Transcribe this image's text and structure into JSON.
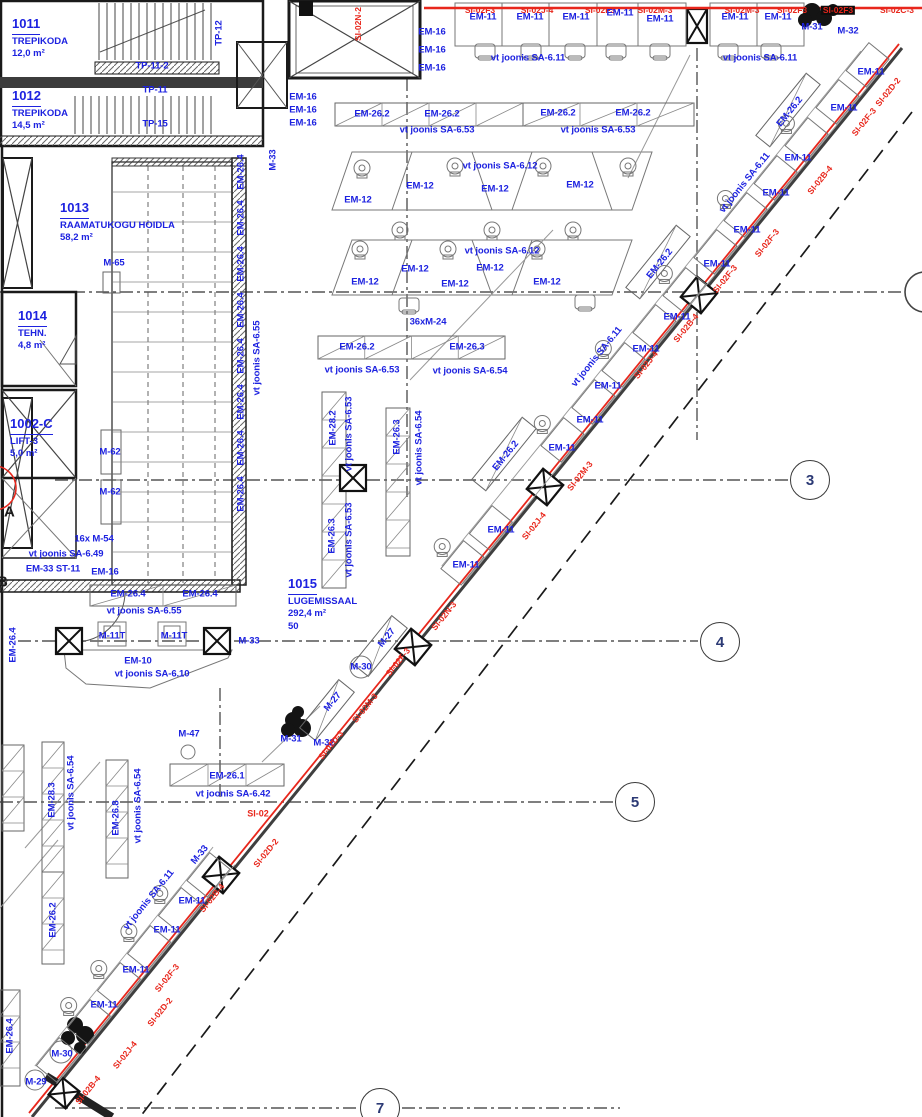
{
  "colors": {
    "blue": "#1d22e0",
    "red": "#e8271c",
    "black": "#1c1c1c",
    "wall": "#1a1a1a",
    "furniture": "#8a8a8a",
    "grid": "#555555"
  },
  "plan": {
    "rooms": [
      {
        "number": "1011",
        "name": "TREPIKODA",
        "area": "12,0 m²",
        "x": 12,
        "y": 14
      },
      {
        "number": "1012",
        "name": "TREPIKODA",
        "area": "14,5 m²",
        "x": 12,
        "y": 86
      },
      {
        "number": "1013",
        "name": "RAAMATUKOGU HOIDLA",
        "area": "58,2 m²",
        "x": 60,
        "y": 198
      },
      {
        "number": "1014",
        "name": "TEHN.",
        "area": "4,8 m²",
        "x": 18,
        "y": 306
      },
      {
        "number": "1002-C",
        "name": "LIFT-3",
        "area": "5,0 m²",
        "x": 10,
        "y": 414
      },
      {
        "number": "1015",
        "name": "LUGEMISSAAL",
        "area": "292,4 m²",
        "extra": "50",
        "x": 288,
        "y": 574
      }
    ],
    "grid_bubbles": [
      {
        "label": "3",
        "x": 810,
        "y": 480
      },
      {
        "label": "4",
        "x": 720,
        "y": 642
      },
      {
        "label": "5",
        "x": 635,
        "y": 802
      },
      {
        "label": "7",
        "x": 380,
        "y": 1108
      }
    ],
    "grid_letters": [
      {
        "label": "A",
        "x": 4,
        "y": 512
      },
      {
        "label": "B",
        "x": -3,
        "y": 582
      }
    ],
    "labels": [
      {
        "t": "TP-11-2",
        "x": 152,
        "y": 66
      },
      {
        "t": "TP-11",
        "x": 155,
        "y": 90
      },
      {
        "t": "TP-15",
        "x": 155,
        "y": 124
      },
      {
        "t": "TP-12",
        "x": 219,
        "y": 33,
        "rot": -90
      },
      {
        "t": "M-33",
        "x": 273,
        "y": 160,
        "rot": -90
      },
      {
        "t": "EM-16",
        "x": 303,
        "y": 97
      },
      {
        "t": "EM-16",
        "x": 303,
        "y": 110
      },
      {
        "t": "EM-16",
        "x": 303,
        "y": 123
      },
      {
        "t": "EM-16",
        "x": 432,
        "y": 32
      },
      {
        "t": "EM-16",
        "x": 432,
        "y": 50
      },
      {
        "t": "EM-16",
        "x": 432,
        "y": 68
      },
      {
        "t": "SI-02N-2",
        "x": 358,
        "y": 24,
        "rot": -90,
        "c": "red"
      },
      {
        "t": "SI-02F3",
        "x": 480,
        "y": 10,
        "c": "red"
      },
      {
        "t": "SI-02J-4",
        "x": 537,
        "y": 10,
        "c": "red"
      },
      {
        "t": "SI-02F3",
        "x": 600,
        "y": 10,
        "c": "red"
      },
      {
        "t": "SI-02M-3",
        "x": 655,
        "y": 10,
        "c": "red"
      },
      {
        "t": "SI-02M-3",
        "x": 742,
        "y": 10,
        "c": "red"
      },
      {
        "t": "SI-02F3",
        "x": 792,
        "y": 10,
        "c": "red"
      },
      {
        "t": "SI-02F3",
        "x": 838,
        "y": 10,
        "c": "red",
        "inv": true
      },
      {
        "t": "SI-02C-3",
        "x": 897,
        "y": 10,
        "c": "red"
      },
      {
        "t": "EM-11",
        "x": 483,
        "y": 17
      },
      {
        "t": "EM-11",
        "x": 530,
        "y": 17
      },
      {
        "t": "EM-11",
        "x": 576,
        "y": 17
      },
      {
        "t": "EM-11",
        "x": 620,
        "y": 13
      },
      {
        "t": "EM-11",
        "x": 660,
        "y": 19
      },
      {
        "t": "EM-11",
        "x": 735,
        "y": 17
      },
      {
        "t": "EM-11",
        "x": 778,
        "y": 17
      },
      {
        "t": "vt joonis SA-6.11",
        "x": 528,
        "y": 58
      },
      {
        "t": "vt joonis SA-6.11",
        "x": 760,
        "y": 58
      },
      {
        "t": "M-31",
        "x": 812,
        "y": 27
      },
      {
        "t": "M-32",
        "x": 848,
        "y": 31
      },
      {
        "t": "EM-26.2",
        "x": 372,
        "y": 114
      },
      {
        "t": "EM-26.2",
        "x": 442,
        "y": 114
      },
      {
        "t": "EM-26.2",
        "x": 558,
        "y": 113
      },
      {
        "t": "EM-26.2",
        "x": 633,
        "y": 113
      },
      {
        "t": "vt joonis SA-6.53",
        "x": 437,
        "y": 130
      },
      {
        "t": "vt joonis SA-6.53",
        "x": 598,
        "y": 130
      },
      {
        "t": "vt joonis SA-6.12",
        "x": 500,
        "y": 166
      },
      {
        "t": "EM-12",
        "x": 358,
        "y": 200
      },
      {
        "t": "EM-12",
        "x": 420,
        "y": 186
      },
      {
        "t": "EM-12",
        "x": 495,
        "y": 189
      },
      {
        "t": "EM-12",
        "x": 580,
        "y": 185
      },
      {
        "t": "vt joonis SA-6.12",
        "x": 502,
        "y": 251
      },
      {
        "t": "EM-12",
        "x": 365,
        "y": 282
      },
      {
        "t": "EM-12",
        "x": 415,
        "y": 269
      },
      {
        "t": "EM-12",
        "x": 455,
        "y": 284
      },
      {
        "t": "EM-12",
        "x": 490,
        "y": 268
      },
      {
        "t": "EM-12",
        "x": 547,
        "y": 282
      },
      {
        "t": "36xM-24",
        "x": 428,
        "y": 322
      },
      {
        "t": "EM-26.2",
        "x": 357,
        "y": 347
      },
      {
        "t": "EM-26.3",
        "x": 467,
        "y": 347
      },
      {
        "t": "vt joonis SA-6.53",
        "x": 362,
        "y": 370
      },
      {
        "t": "vt joonis SA-6.54",
        "x": 470,
        "y": 371
      },
      {
        "t": "EM-28.2",
        "x": 333,
        "y": 428,
        "rot": -90
      },
      {
        "t": "vt joonis SA-6.53",
        "x": 349,
        "y": 434,
        "rot": -90
      },
      {
        "t": "EM-26.3",
        "x": 332,
        "y": 536,
        "rot": -90
      },
      {
        "t": "vt joonis SA-6.53",
        "x": 349,
        "y": 540,
        "rot": -90
      },
      {
        "t": "EM-26.3",
        "x": 397,
        "y": 437,
        "rot": -90
      },
      {
        "t": "vt joonis SA-6.54",
        "x": 419,
        "y": 448,
        "rot": -90
      },
      {
        "t": "EM-26.4",
        "x": 241,
        "y": 172,
        "rot": -90
      },
      {
        "t": "EM-26.4",
        "x": 241,
        "y": 218,
        "rot": -90
      },
      {
        "t": "EM-26.4",
        "x": 241,
        "y": 264,
        "rot": -90
      },
      {
        "t": "EM-26.4",
        "x": 241,
        "y": 310,
        "rot": -90
      },
      {
        "t": "EM-26.4",
        "x": 241,
        "y": 356,
        "rot": -90
      },
      {
        "t": "EM-26.4",
        "x": 241,
        "y": 402,
        "rot": -90
      },
      {
        "t": "EM-26.4",
        "x": 241,
        "y": 448,
        "rot": -90
      },
      {
        "t": "EM-26.4",
        "x": 241,
        "y": 494,
        "rot": -90
      },
      {
        "t": "vt joonis SA-6.55",
        "x": 257,
        "y": 358,
        "rot": -90
      },
      {
        "t": "M-65",
        "x": 114,
        "y": 263
      },
      {
        "t": "M-62",
        "x": 110,
        "y": 452
      },
      {
        "t": "M-62",
        "x": 110,
        "y": 492
      },
      {
        "t": "16x M-54",
        "x": 94,
        "y": 539
      },
      {
        "t": "vt joonis SA-6.49",
        "x": 66,
        "y": 554
      },
      {
        "t": "EM-33 ST-11",
        "x": 53,
        "y": 569
      },
      {
        "t": "EM-16",
        "x": 105,
        "y": 572
      },
      {
        "t": "EM-26.4",
        "x": 128,
        "y": 594
      },
      {
        "t": "EM-26.4",
        "x": 200,
        "y": 594
      },
      {
        "t": "vt joonis SA-6.55",
        "x": 144,
        "y": 611
      },
      {
        "t": "M-11T",
        "x": 112,
        "y": 636
      },
      {
        "t": "M-11T",
        "x": 174,
        "y": 636
      },
      {
        "t": "M-33",
        "x": 249,
        "y": 641
      },
      {
        "t": "EM-10",
        "x": 138,
        "y": 661
      },
      {
        "t": "vt joonis SA-6.10",
        "x": 152,
        "y": 674
      },
      {
        "t": "M-27",
        "x": 387,
        "y": 638,
        "rot": -51
      },
      {
        "t": "M-27",
        "x": 333,
        "y": 702,
        "rot": -51
      },
      {
        "t": "M-30",
        "x": 361,
        "y": 667
      },
      {
        "t": "M-31",
        "x": 291,
        "y": 739
      },
      {
        "t": "M-32",
        "x": 324,
        "y": 743
      },
      {
        "t": "M-47",
        "x": 189,
        "y": 734
      },
      {
        "t": "EM-26.1",
        "x": 227,
        "y": 776
      },
      {
        "t": "vt joonis SA-6.42",
        "x": 233,
        "y": 794
      },
      {
        "t": "SI-02",
        "x": 258,
        "y": 814,
        "c": "red",
        "s": 9
      },
      {
        "t": "M-33",
        "x": 200,
        "y": 855,
        "rot": -51
      },
      {
        "t": "EM-28.3",
        "x": 52,
        "y": 800,
        "rot": -90
      },
      {
        "t": "vt joonis SA-6.54",
        "x": 71,
        "y": 793,
        "rot": -90
      },
      {
        "t": "EM-26.8",
        "x": 116,
        "y": 818,
        "rot": -90
      },
      {
        "t": "vt joonis SA-6.54",
        "x": 138,
        "y": 806,
        "rot": -90
      },
      {
        "t": "EM-26.2",
        "x": 53,
        "y": 920,
        "rot": -90
      },
      {
        "t": "EM-26.4",
        "x": 13,
        "y": 645,
        "rot": -90
      },
      {
        "t": "EM-26.4",
        "x": 10,
        "y": 1036,
        "rot": -90
      },
      {
        "t": "EM-26.2",
        "x": 790,
        "y": 112,
        "rot": -51
      },
      {
        "t": "EM-26.2",
        "x": 660,
        "y": 264,
        "rot": -51
      },
      {
        "t": "EM-26.2",
        "x": 506,
        "y": 456,
        "rot": -51
      },
      {
        "t": "vt joonis SA-6.11",
        "x": 745,
        "y": 183,
        "rot": -51
      },
      {
        "t": "vt joonis SA-6.11",
        "x": 597,
        "y": 357,
        "rot": -51
      },
      {
        "t": "vt joonis SA-6.11",
        "x": 149,
        "y": 900,
        "rot": -51
      },
      {
        "t": "EM-11",
        "x": 871,
        "y": 72
      },
      {
        "t": "EM-11",
        "x": 844,
        "y": 108
      },
      {
        "t": "EM-11",
        "x": 798,
        "y": 158
      },
      {
        "t": "EM-11",
        "x": 776,
        "y": 193
      },
      {
        "t": "EM-11",
        "x": 747,
        "y": 230
      },
      {
        "t": "EM-11",
        "x": 717,
        "y": 264
      },
      {
        "t": "EM-11",
        "x": 677,
        "y": 317
      },
      {
        "t": "EM-11",
        "x": 646,
        "y": 349
      },
      {
        "t": "EM-11",
        "x": 608,
        "y": 386
      },
      {
        "t": "EM-11",
        "x": 590,
        "y": 420
      },
      {
        "t": "EM-11",
        "x": 562,
        "y": 448
      },
      {
        "t": "EM-11",
        "x": 501,
        "y": 530
      },
      {
        "t": "EM-11",
        "x": 466,
        "y": 565
      },
      {
        "t": "EM-11",
        "x": 192,
        "y": 901
      },
      {
        "t": "EM-11",
        "x": 167,
        "y": 930
      },
      {
        "t": "EM-11",
        "x": 136,
        "y": 970
      },
      {
        "t": "EM-11",
        "x": 104,
        "y": 1005
      },
      {
        "t": "M-30",
        "x": 62,
        "y": 1054
      },
      {
        "t": "M-29",
        "x": 36,
        "y": 1082
      },
      {
        "t": "SI-02D-2",
        "x": 888,
        "y": 92,
        "rot": -51,
        "c": "red"
      },
      {
        "t": "SI-02F-3",
        "x": 864,
        "y": 122,
        "rot": -51,
        "c": "red"
      },
      {
        "t": "SI-02B-4",
        "x": 820,
        "y": 180,
        "rot": -51,
        "c": "red"
      },
      {
        "t": "SI-02F-3",
        "x": 767,
        "y": 243,
        "rot": -51,
        "c": "red"
      },
      {
        "t": "SI-02F-3",
        "x": 725,
        "y": 279,
        "rot": -51,
        "c": "red"
      },
      {
        "t": "SI-02B-4",
        "x": 686,
        "y": 328,
        "rot": -51,
        "c": "red"
      },
      {
        "t": "SI-02J-4",
        "x": 646,
        "y": 365,
        "rot": -51,
        "c": "red"
      },
      {
        "t": "SI-02M-3",
        "x": 580,
        "y": 476,
        "rot": -51,
        "c": "red"
      },
      {
        "t": "SI-02J-4",
        "x": 534,
        "y": 526,
        "rot": -51,
        "c": "red"
      },
      {
        "t": "SI-02N-3",
        "x": 444,
        "y": 616,
        "rot": -51,
        "c": "red"
      },
      {
        "t": "SI-02F-3",
        "x": 398,
        "y": 662,
        "rot": -51,
        "c": "red"
      },
      {
        "t": "SI-02M-3",
        "x": 365,
        "y": 708,
        "rot": -51,
        "c": "red"
      },
      {
        "t": "SI-02D-3",
        "x": 331,
        "y": 745,
        "rot": -51,
        "c": "red"
      },
      {
        "t": "SI-02D-2",
        "x": 266,
        "y": 853,
        "rot": -51,
        "c": "red"
      },
      {
        "t": "SI-02B-4",
        "x": 212,
        "y": 898,
        "rot": -51,
        "c": "red"
      },
      {
        "t": "SI-02F-3",
        "x": 167,
        "y": 978,
        "rot": -51,
        "c": "red"
      },
      {
        "t": "SI-02D-2",
        "x": 160,
        "y": 1012,
        "rot": -51,
        "c": "red"
      },
      {
        "t": "SI-02J-4",
        "x": 125,
        "y": 1055,
        "rot": -51,
        "c": "red"
      },
      {
        "t": "SI-02B-4",
        "x": 88,
        "y": 1090,
        "rot": -51,
        "c": "red"
      }
    ]
  }
}
